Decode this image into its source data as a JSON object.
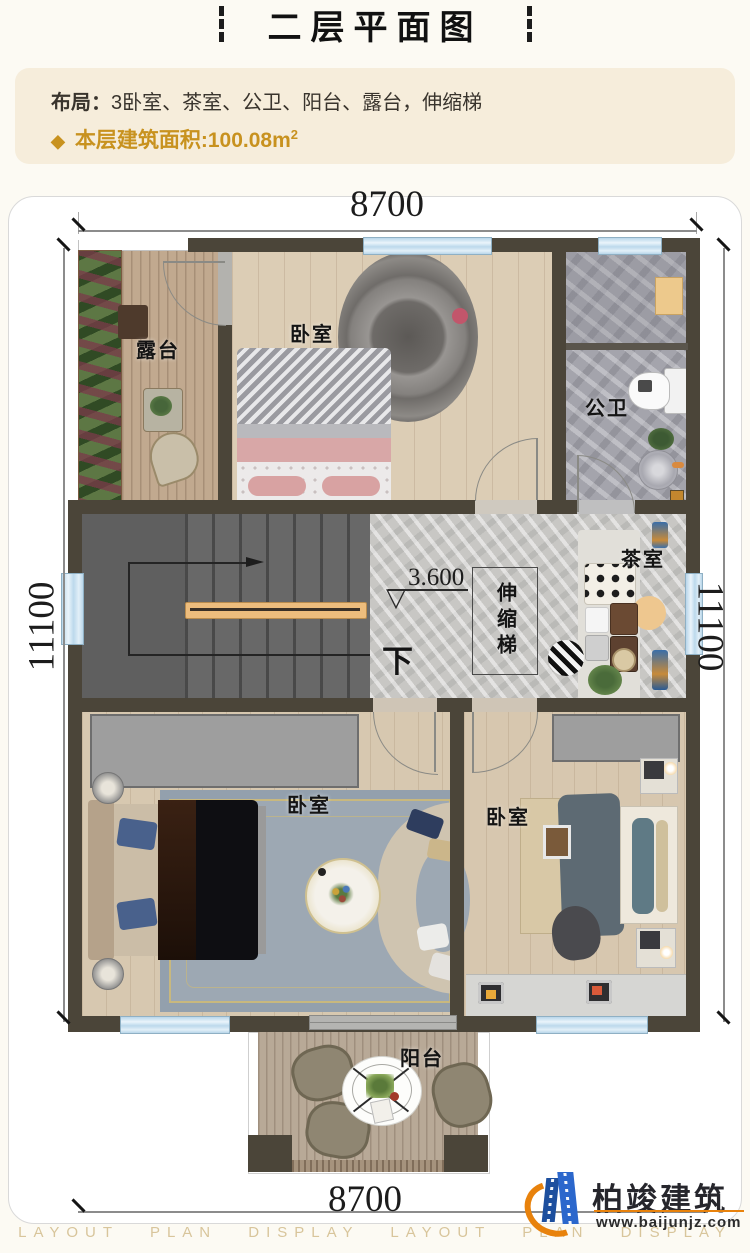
{
  "page": {
    "title": "二层平面图",
    "info_layout_label": "布局：",
    "info_layout_value": "3卧室、茶室、公卫、阳台、露台，伸缩梯",
    "info_area_prefix": "◆",
    "info_area_text": "本层建筑面积:100.08m",
    "info_area_sup": "2"
  },
  "dims": {
    "top": "8700",
    "bottom": "8700",
    "left": "11100",
    "right": "11100"
  },
  "rooms": {
    "terrace": "露台",
    "bedroom_top": "卧室",
    "bathroom": "公卫",
    "tea_room": "茶室",
    "ladder": "伸缩梯",
    "down_label": "下",
    "elevation": "3.600",
    "elevation_symbol": "▽",
    "bedroom_left": "卧室",
    "bedroom_right": "卧室",
    "balcony": "阳台"
  },
  "brand": {
    "name": "柏竣建筑",
    "url": "www.baijunjz.com",
    "strip": "LAYOUT PLAN DISPLAY LAYOUT PLAN DISPLAY"
  },
  "colors": {
    "accent_gold": "#c8921f",
    "wall": "#4b4539",
    "window_blue": "#cfe3f1",
    "info_bg": "#f6eddb",
    "logo_orange": "#e8820c",
    "logo_blue": "#2b67cc"
  }
}
